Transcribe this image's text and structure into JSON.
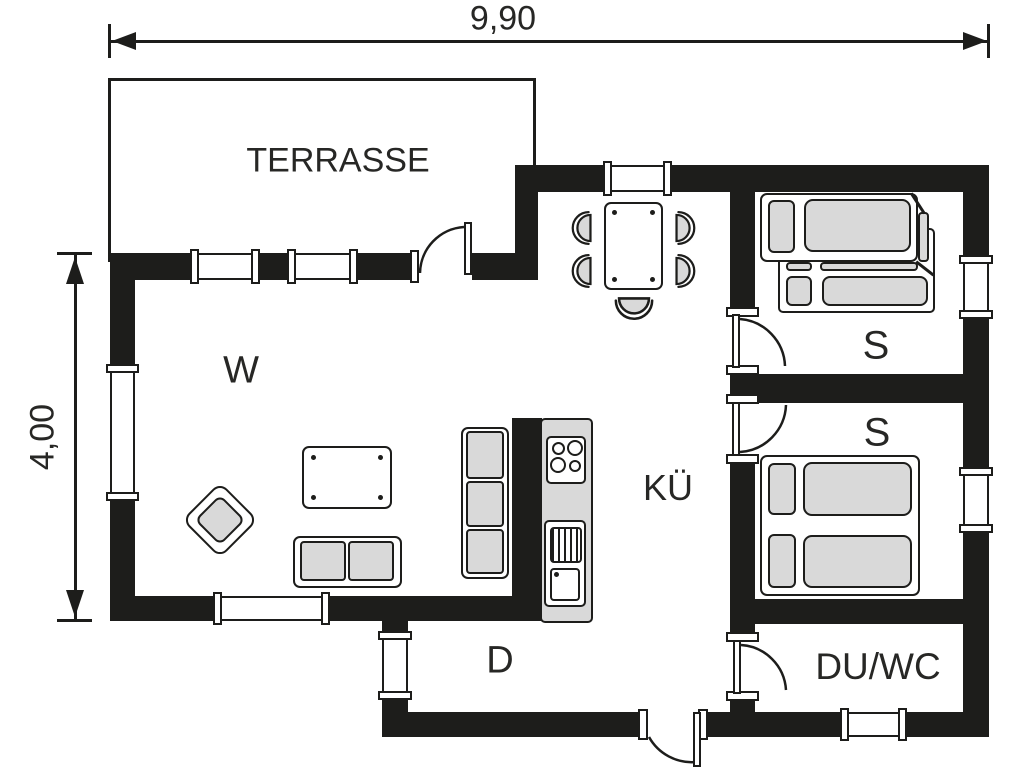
{
  "plan": {
    "dimensions": {
      "width_label": "9,90",
      "height_label": "4,00"
    },
    "rooms": {
      "terrace": "TERRASSE",
      "living": "W",
      "kitchen": "KÜ",
      "bedroom_top": "S",
      "bedroom_bottom": "S",
      "hallway": "D",
      "bathroom": "DU/WC"
    },
    "colors": {
      "wall": "#1d1d1b",
      "furniture_fill": "#d9d9d9",
      "background": "#ffffff",
      "text": "#272725"
    }
  }
}
